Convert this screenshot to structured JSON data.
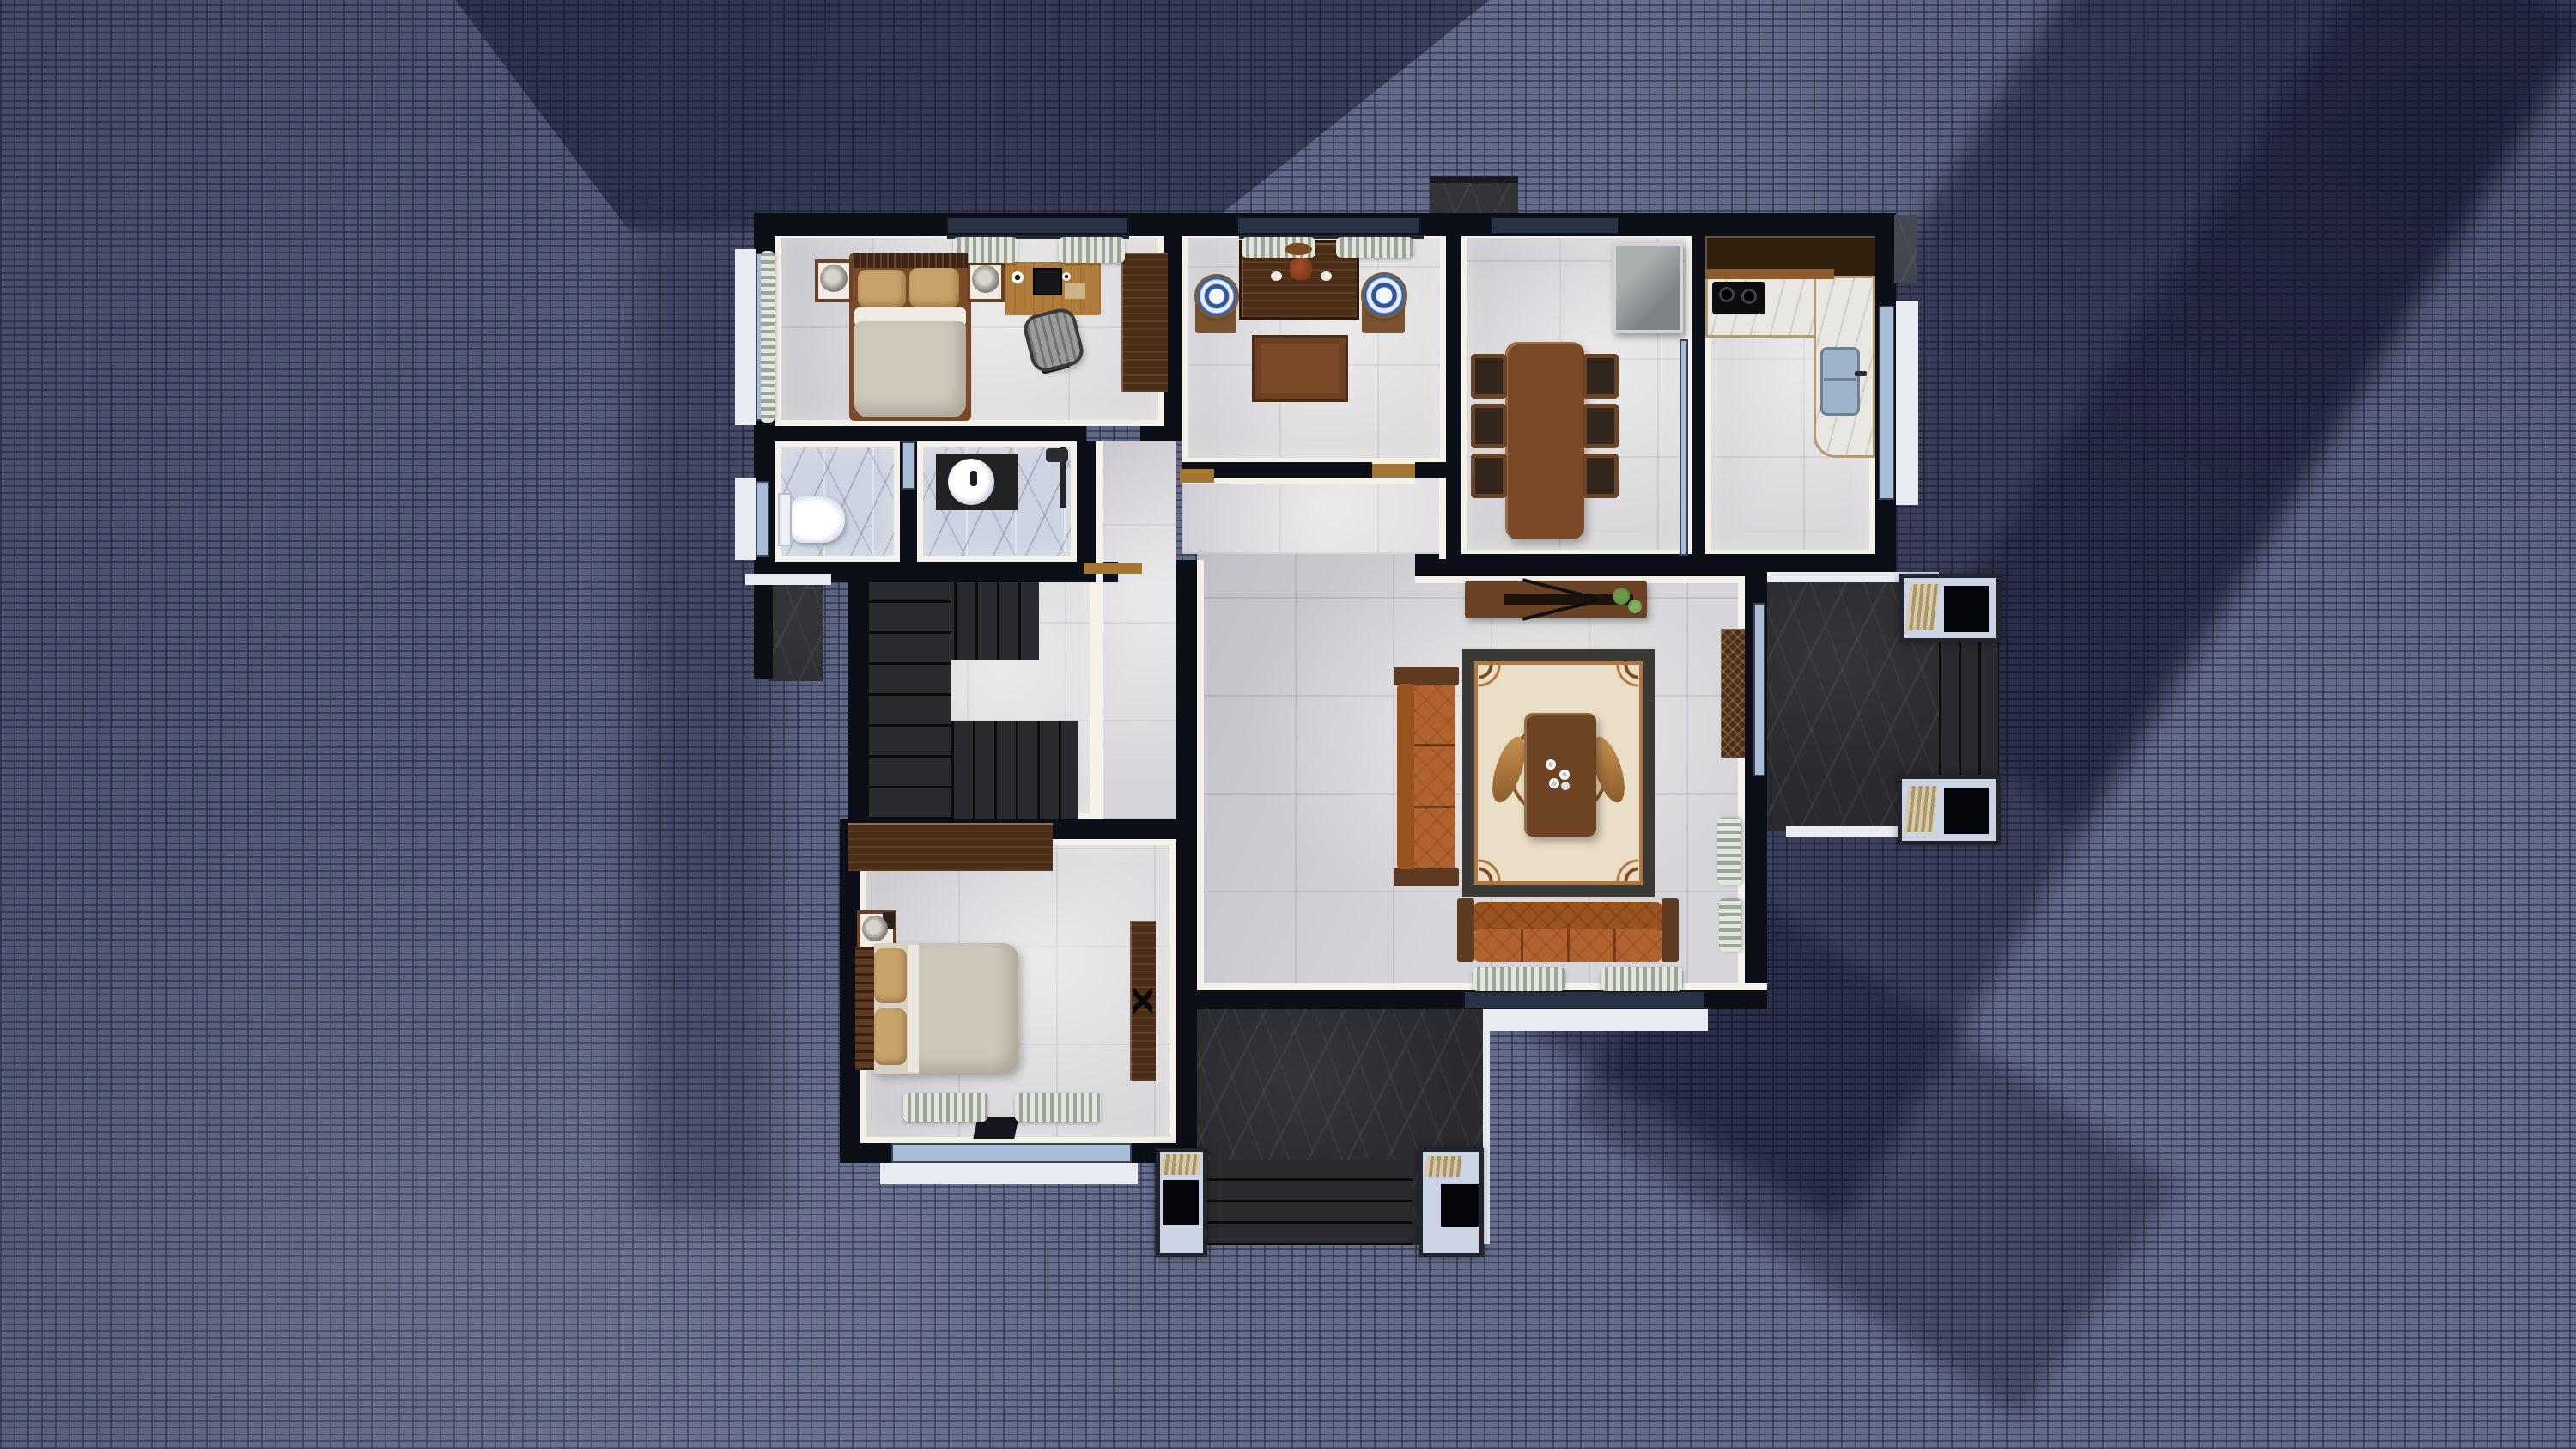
{
  "scene": {
    "title": "Top-down 3D rendered house floor plan at dusk",
    "view": "overhead orthographic",
    "ground": "blue-grey herringbone pavers with long cast shadows",
    "lighting": "warm interior lights, cool exterior dusk"
  },
  "palette": {
    "wall": "#0d0f18",
    "inner_face": "#f4f1e9",
    "floor_tile": "#d6d5d9",
    "bath_marble": "#ccd3e2",
    "counter_marble": "#e9e7e2",
    "dark_stone": "#2b2a2e",
    "walnut": "#4c2e18",
    "oak": "#b07c3a",
    "sofa_orange": "#b2622c",
    "pillow_tan": "#c8a36b",
    "glass_blue": "#a9bdd6",
    "glass_dark": "#2a3248",
    "paver": "#666d8c",
    "porcelain_blue": "#2f57a0",
    "rug_cream": "#eadfc6",
    "rug_border": "#3b3936"
  },
  "rooms": [
    {
      "name": "Master bedroom",
      "furniture": [
        "double bed with tan pillows",
        "two nightstands with round lamps",
        "oak computer desk with monitor",
        "grey office chair",
        "walnut wardrobe",
        "wavy window curtains"
      ]
    },
    {
      "name": "Tea room study",
      "furniture": [
        "walnut altar console with vase and flowers",
        "square tea table",
        "two blue-white porcelain drum stools",
        "window curtains"
      ]
    },
    {
      "name": "Dining room",
      "furniture": [
        "rectangular walnut dining table",
        "six wood chairs with dark seats",
        "grey refrigerator",
        "sliding glass partition"
      ]
    },
    {
      "name": "Kitchen",
      "furniture": [
        "L-shaped white marble counter",
        "two-burner black cooktop",
        "stainless double sink",
        "dark walnut upper cabinets",
        "side window"
      ]
    },
    {
      "name": "Toilet room",
      "furniture": [
        "white toilet",
        "blue marble floor",
        "small window"
      ]
    },
    {
      "name": "Bathroom",
      "furniture": [
        "dark vanity with round white basin",
        "shower set",
        "blue marble floor",
        "glazed partition light"
      ]
    },
    {
      "name": "Hallway",
      "furniture": [
        "wood door thresholds"
      ]
    },
    {
      "name": "Staircase",
      "furniture": [
        "U-shaped dark stone stair with winder treads"
      ]
    },
    {
      "name": "Living room",
      "furniture": [
        "walnut TV console with plants",
        "ornate cream rug with medallion",
        "walnut coffee table with tea set",
        "long orange tufted sofa",
        "four-seat orange tufted sofa",
        "carved display cabinet",
        "curtained windows"
      ]
    },
    {
      "name": "Second bedroom",
      "furniture": [
        "double bed with slat headboard",
        "walnut wardrobe",
        "nightstand with lamp",
        "tall media console",
        "window curtains"
      ]
    }
  ],
  "exterior": [
    {
      "name": "Front porch",
      "features": [
        "dark stone slab",
        "four steps",
        "two white planter pedestals with mats"
      ]
    },
    {
      "name": "Side deck",
      "features": [
        "dark stone slab",
        "three steps",
        "two white planter pedestals"
      ]
    },
    {
      "name": "Side stoop",
      "features": [
        "small dark stone platform"
      ]
    },
    {
      "name": "Chimney block",
      "features": [
        "dark stone cap above top wall"
      ]
    },
    {
      "name": "Paver ground",
      "features": [
        "herringbone brick paving",
        "diagonal tree and house shadows"
      ]
    }
  ]
}
